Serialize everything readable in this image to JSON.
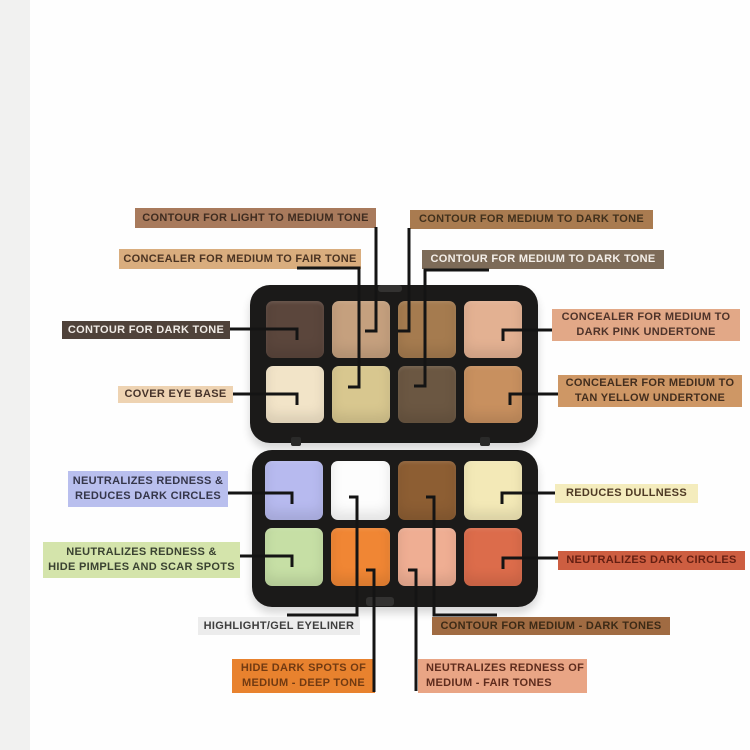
{
  "canvas": {
    "width": 750,
    "height": 750,
    "background": "#fefefe",
    "left_strip_color": "#f1f1f0",
    "left_strip_width": 30
  },
  "line_color": "#141414",
  "palette": {
    "case_color": "#1b1a19",
    "top_half": {
      "x": 250,
      "y": 285,
      "w": 288,
      "h": 158,
      "grid": {
        "x": 266,
        "y": 301,
        "w": 256,
        "h": 122
      },
      "swatches": [
        {
          "name": "contour-dark-tone",
          "color": "#5b463c"
        },
        {
          "name": "contour-light-medium-tone",
          "color": "#c5a07e"
        },
        {
          "name": "contour-medium-dark-tone-a",
          "color": "#a57b4f"
        },
        {
          "name": "concealer-dark-pink-undertone",
          "color": "#e3b192"
        },
        {
          "name": "cover-eye-base",
          "color": "#f2e4c8"
        },
        {
          "name": "concealer-medium-fair-tone",
          "color": "#d8c78f"
        },
        {
          "name": "contour-medium-dark-tone-b",
          "color": "#6b5742"
        },
        {
          "name": "concealer-tan-yellow-undertone",
          "color": "#c8905f"
        }
      ]
    },
    "bottom_half": {
      "x": 252,
      "y": 450,
      "w": 286,
      "h": 157,
      "grid": {
        "x": 265,
        "y": 461,
        "w": 257,
        "h": 125
      },
      "swatches": [
        {
          "name": "neutralizes-redness-dark-circles",
          "color": "#b7baef"
        },
        {
          "name": "highlight-gel-eyeliner",
          "color": "#fdfdfd"
        },
        {
          "name": "contour-medium-dark-tones",
          "color": "#8d5e33"
        },
        {
          "name": "reduces-dullness",
          "color": "#f3e9b7"
        },
        {
          "name": "neutralizes-redness-pimples-scars",
          "color": "#c6dfa5"
        },
        {
          "name": "hide-dark-spots",
          "color": "#f08634"
        },
        {
          "name": "neutralizes-redness-fair",
          "color": "#efae93"
        },
        {
          "name": "neutralizes-dark-circles",
          "color": "#dc6c4b"
        }
      ]
    },
    "hinge_tabs": [
      {
        "x": 291,
        "y": 437
      },
      {
        "x": 480,
        "y": 437
      }
    ],
    "clasps": [
      {
        "x": 378,
        "y": 285,
        "w": 24,
        "h": 7
      },
      {
        "x": 366,
        "y": 597,
        "w": 28,
        "h": 9
      }
    ]
  },
  "labels": [
    {
      "id": "contour-light-medium",
      "text": [
        "CONTOUR FOR LIGHT TO MEDIUM TONE"
      ],
      "x": 135,
      "y": 208,
      "w": 241,
      "h": 20,
      "bg": "#a87a5c",
      "fg": "#3f2c20"
    },
    {
      "id": "concealer-medium-fair",
      "text": [
        "CONCEALER FOR MEDIUM TO FAIR TONE"
      ],
      "x": 119,
      "y": 249,
      "w": 242,
      "h": 20,
      "bg": "#d9ad7e",
      "fg": "#4a3322"
    },
    {
      "id": "contour-medium-dark-1",
      "text": [
        "CONTOUR FOR MEDIUM TO DARK TONE"
      ],
      "x": 410,
      "y": 210,
      "w": 243,
      "h": 19,
      "bg": "#a97b50",
      "fg": "#41301c"
    },
    {
      "id": "contour-medium-dark-2",
      "text": [
        "CONTOUR FOR MEDIUM TO DARK TONE"
      ],
      "x": 422,
      "y": 250,
      "w": 242,
      "h": 19,
      "bg": "#7d6b58",
      "fg": "#f4efe9"
    },
    {
      "id": "contour-dark",
      "text": [
        "CONTOUR FOR DARK TONE"
      ],
      "x": 62,
      "y": 321,
      "w": 168,
      "h": 18,
      "bg": "#4f423a",
      "fg": "#efeae5"
    },
    {
      "id": "cover-eye-base",
      "text": [
        "COVER EYE BASE"
      ],
      "x": 118,
      "y": 386,
      "w": 115,
      "h": 17,
      "bg": "#eed3b2",
      "fg": "#46332a"
    },
    {
      "id": "concealer-dark-pink",
      "text": [
        "CONCEALER FOR MEDIUM TO",
        "DARK PINK UNDERTONE"
      ],
      "x": 552,
      "y": 309,
      "w": 188,
      "h": 32,
      "bg": "#e2a887",
      "fg": "#4e332a"
    },
    {
      "id": "concealer-tan-yellow",
      "text": [
        "CONCEALER FOR MEDIUM TO",
        "TAN YELLOW UNDERTONE"
      ],
      "x": 558,
      "y": 375,
      "w": 184,
      "h": 32,
      "bg": "#ce9765",
      "fg": "#432e1e"
    },
    {
      "id": "neutralizes-reduces",
      "text": [
        "NEUTRALIZES REDNESS &",
        "REDUCES DARK CIRCLES"
      ],
      "x": 68,
      "y": 471,
      "w": 160,
      "h": 36,
      "bg": "#b9bfee",
      "fg": "#35364a"
    },
    {
      "id": "reduces-dullness",
      "text": [
        "REDUCES DULLNESS"
      ],
      "x": 555,
      "y": 484,
      "w": 143,
      "h": 19,
      "bg": "#f4ecbd",
      "fg": "#4e3a24"
    },
    {
      "id": "neutralizes-pimples",
      "text": [
        "NEUTRALIZES REDNESS &",
        "HIDE PIMPLES AND SCAR SPOTS"
      ],
      "x": 43,
      "y": 542,
      "w": 197,
      "h": 36,
      "bg": "#d4e4ab",
      "fg": "#3a4231"
    },
    {
      "id": "neutralizes-dark-circles",
      "text": [
        "NEUTRALIZES DARK CIRCLES"
      ],
      "x": 558,
      "y": 551,
      "w": 187,
      "h": 19,
      "bg": "#cd5e41",
      "fg": "#641f12"
    },
    {
      "id": "highlight-gel",
      "text": [
        "HIGHLIGHT/GEL EYELINER"
      ],
      "x": 198,
      "y": 617,
      "w": 162,
      "h": 18,
      "bg": "#ececec",
      "fg": "#3e3e3e"
    },
    {
      "id": "contour-medium-dark-tones",
      "text": [
        "CONTOUR FOR MEDIUM - DARK TONES"
      ],
      "x": 432,
      "y": 617,
      "w": 238,
      "h": 18,
      "bg": "#a06b42",
      "fg": "#3c2a16"
    },
    {
      "id": "hide-dark-spots",
      "text": [
        "HIDE DARK SPOTS OF",
        "MEDIUM - DEEP TONE"
      ],
      "x": 232,
      "y": 659,
      "w": 143,
      "h": 34,
      "bg": "#e8822e",
      "fg": "#713a12"
    },
    {
      "id": "neutralizes-redness-fair",
      "text": [
        "NEUTRALIZES REDNESS OF",
        "MEDIUM - FAIR TONES"
      ],
      "x": 418,
      "y": 659,
      "w": 169,
      "h": 34,
      "bg": "#e9a585",
      "fg": "#5e2c1d",
      "align": "left"
    }
  ],
  "connectors": [
    {
      "id": "contour-light-medium",
      "points": [
        [
          376,
          227
        ],
        [
          376,
          331
        ],
        [
          365,
          331
        ]
      ]
    },
    {
      "id": "concealer-medium-fair",
      "points": [
        [
          297,
          268
        ],
        [
          359,
          268
        ],
        [
          359,
          387
        ],
        [
          348,
          387
        ]
      ]
    },
    {
      "id": "contour-medium-dark-1",
      "points": [
        [
          409,
          228
        ],
        [
          409,
          331
        ],
        [
          398,
          331
        ]
      ]
    },
    {
      "id": "contour-medium-dark-2",
      "points": [
        [
          489,
          270
        ],
        [
          425,
          270
        ],
        [
          425,
          386
        ],
        [
          414,
          386
        ]
      ]
    },
    {
      "id": "contour-dark",
      "points": [
        [
          230,
          329
        ],
        [
          297,
          329
        ],
        [
          297,
          340
        ]
      ]
    },
    {
      "id": "cover-eye-base",
      "points": [
        [
          233,
          394
        ],
        [
          297,
          394
        ],
        [
          297,
          405
        ]
      ]
    },
    {
      "id": "concealer-dark-pink",
      "points": [
        [
          552,
          330
        ],
        [
          503,
          330
        ],
        [
          503,
          341
        ]
      ]
    },
    {
      "id": "concealer-tan-yellow",
      "points": [
        [
          558,
          394
        ],
        [
          510,
          394
        ],
        [
          510,
          405
        ]
      ]
    },
    {
      "id": "neutralizes-reduces",
      "points": [
        [
          228,
          493
        ],
        [
          292,
          493
        ],
        [
          292,
          504
        ]
      ]
    },
    {
      "id": "reduces-dullness",
      "points": [
        [
          555,
          493
        ],
        [
          502,
          493
        ],
        [
          502,
          504
        ]
      ]
    },
    {
      "id": "neutralizes-pimples",
      "points": [
        [
          240,
          556
        ],
        [
          292,
          556
        ],
        [
          292,
          567
        ]
      ]
    },
    {
      "id": "neutralizes-dark-circles",
      "points": [
        [
          558,
          558
        ],
        [
          503,
          558
        ],
        [
          503,
          569
        ]
      ]
    },
    {
      "id": "highlight-gel",
      "points": [
        [
          349,
          497
        ],
        [
          357,
          497
        ],
        [
          357,
          615
        ],
        [
          287,
          615
        ]
      ]
    },
    {
      "id": "contour-medium-dark-tones",
      "points": [
        [
          426,
          497
        ],
        [
          434,
          497
        ],
        [
          434,
          615
        ],
        [
          497,
          615
        ]
      ]
    },
    {
      "id": "hide-dark-spots",
      "points": [
        [
          366,
          570
        ],
        [
          374,
          570
        ],
        [
          374,
          692
        ]
      ]
    },
    {
      "id": "neutralizes-redness-fair",
      "points": [
        [
          408,
          570
        ],
        [
          416,
          570
        ],
        [
          416,
          691
        ]
      ]
    }
  ]
}
